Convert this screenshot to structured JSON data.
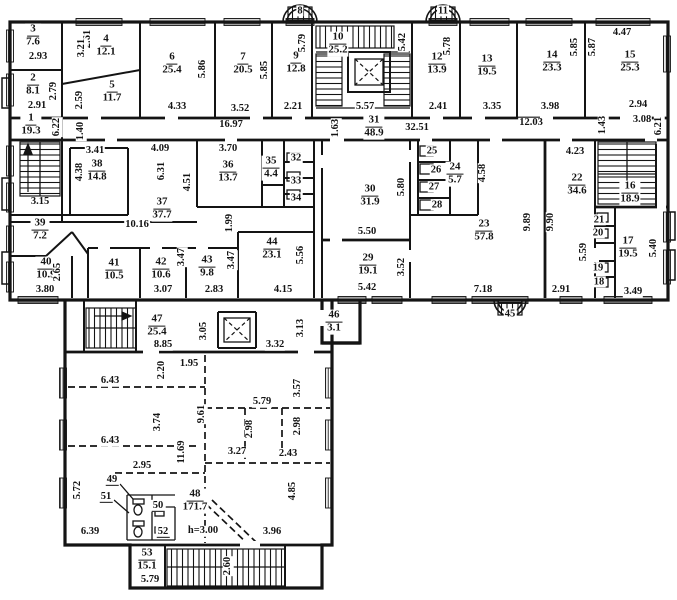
{
  "plan": {
    "type": "architectural-floor-plan",
    "colors": {
      "ink": "#141414",
      "background": "#ffffff"
    },
    "rooms": [
      {
        "num": "3",
        "area": "7.6",
        "x": 33,
        "y": 36
      },
      {
        "num": "2",
        "area": "8.1",
        "x": 33,
        "y": 85
      },
      {
        "num": "1",
        "area": "19.3",
        "x": 31,
        "y": 125
      },
      {
        "num": "4",
        "area": "12.1",
        "x": 106,
        "y": 46
      },
      {
        "num": "5",
        "area": "11.7",
        "x": 112,
        "y": 92
      },
      {
        "num": "6",
        "area": "25.4",
        "x": 172,
        "y": 64
      },
      {
        "num": "7",
        "area": "20.5",
        "x": 243,
        "y": 64
      },
      {
        "num": "9",
        "area": "12.8",
        "x": 296,
        "y": 63
      },
      {
        "num": "10",
        "area": "25.2",
        "x": 338,
        "y": 44
      },
      {
        "num": "12",
        "area": "13.9",
        "x": 437,
        "y": 64
      },
      {
        "num": "13",
        "area": "19.5",
        "x": 487,
        "y": 66
      },
      {
        "num": "14",
        "area": "23.3",
        "x": 552,
        "y": 62
      },
      {
        "num": "15",
        "area": "25.3",
        "x": 630,
        "y": 62
      },
      {
        "num": "31",
        "area": "48.9",
        "x": 374,
        "y": 127
      },
      {
        "num": "38",
        "area": "14.8",
        "x": 97,
        "y": 171
      },
      {
        "num": "37",
        "area": "37.7",
        "x": 162,
        "y": 209
      },
      {
        "num": "36",
        "area": "13.7",
        "x": 228,
        "y": 172
      },
      {
        "num": "35",
        "area": "4.4",
        "x": 271,
        "y": 168
      },
      {
        "num": "30",
        "area": "31.9",
        "x": 370,
        "y": 196
      },
      {
        "num": "24",
        "area": "5.7",
        "x": 455,
        "y": 174
      },
      {
        "num": "23",
        "area": "57.8",
        "x": 484,
        "y": 231
      },
      {
        "num": "22",
        "area": "34.6",
        "x": 577,
        "y": 185
      },
      {
        "num": "16",
        "area": "18.9",
        "x": 630,
        "y": 193
      },
      {
        "num": "17",
        "area": "19.5",
        "x": 628,
        "y": 248
      },
      {
        "num": "39",
        "area": "7.2",
        "x": 40,
        "y": 230
      },
      {
        "num": "40",
        "area": "10.9",
        "x": 46,
        "y": 269
      },
      {
        "num": "41",
        "area": "10.5",
        "x": 114,
        "y": 270
      },
      {
        "num": "42",
        "area": "10.6",
        "x": 161,
        "y": 269
      },
      {
        "num": "43",
        "area": "9.8",
        "x": 207,
        "y": 267
      },
      {
        "num": "44",
        "area": "23.1",
        "x": 272,
        "y": 249
      },
      {
        "num": "29",
        "area": "19.1",
        "x": 368,
        "y": 265
      },
      {
        "num": "46",
        "area": "3.1",
        "x": 334,
        "y": 322
      },
      {
        "num": "47",
        "area": "25.4",
        "x": 157,
        "y": 326
      },
      {
        "num": "48",
        "area": "171.7",
        "x": 195,
        "y": 501
      },
      {
        "num": "53",
        "area": "15.1",
        "x": 147,
        "y": 560
      },
      {
        "num": "8",
        "area": "",
        "x": 300,
        "y": 11,
        "plain": 1
      },
      {
        "num": "11",
        "area": "",
        "x": 443,
        "y": 11,
        "plain": 1
      },
      {
        "num": "45",
        "area": "",
        "x": 510,
        "y": 314,
        "plain": 1
      },
      {
        "num": "32",
        "area": "",
        "x": 296,
        "y": 158,
        "plain": 1
      },
      {
        "num": "33",
        "area": "",
        "x": 296,
        "y": 181,
        "plain": 1
      },
      {
        "num": "34",
        "area": "",
        "x": 296,
        "y": 198,
        "plain": 1
      },
      {
        "num": "25",
        "area": "",
        "x": 432,
        "y": 151,
        "plain": 1
      },
      {
        "num": "26",
        "area": "",
        "x": 436,
        "y": 170,
        "plain": 1
      },
      {
        "num": "27",
        "area": "",
        "x": 434,
        "y": 187,
        "plain": 1
      },
      {
        "num": "28",
        "area": "",
        "x": 437,
        "y": 205,
        "plain": 1
      },
      {
        "num": "21",
        "area": "",
        "x": 599,
        "y": 220,
        "plain": 1
      },
      {
        "num": "20",
        "area": "",
        "x": 598,
        "y": 233,
        "plain": 1
      },
      {
        "num": "19",
        "area": "",
        "x": 598,
        "y": 268,
        "plain": 1
      },
      {
        "num": "18",
        "area": "",
        "x": 599,
        "y": 282,
        "plain": 1
      },
      {
        "num": "49",
        "area": "",
        "x": 112,
        "y": 480,
        "plain": 1,
        "u": 1
      },
      {
        "num": "51",
        "area": "",
        "x": 106,
        "y": 497,
        "plain": 1,
        "u": 1
      },
      {
        "num": "50",
        "area": "",
        "x": 158,
        "y": 506,
        "plain": 1,
        "u": 1
      },
      {
        "num": "52",
        "area": "",
        "x": 163,
        "y": 532,
        "plain": 1,
        "u": 1
      }
    ],
    "dims": [
      {
        "t": "2.61",
        "x": 88,
        "y": 39,
        "r": 1
      },
      {
        "t": "3.21",
        "x": 82,
        "y": 48,
        "r": 1
      },
      {
        "t": "2.93",
        "x": 38,
        "y": 57
      },
      {
        "t": "2.79",
        "x": 54,
        "y": 91,
        "r": 1
      },
      {
        "t": "2.59",
        "x": 80,
        "y": 100,
        "r": 1
      },
      {
        "t": "2.91",
        "x": 37,
        "y": 106
      },
      {
        "t": "6.22",
        "x": 57,
        "y": 127,
        "r": 1
      },
      {
        "t": "1.40",
        "x": 81,
        "y": 131,
        "r": 1
      },
      {
        "t": "5.86",
        "x": 203,
        "y": 69,
        "r": 1
      },
      {
        "t": "4.33",
        "x": 177,
        "y": 107
      },
      {
        "t": "5.85",
        "x": 265,
        "y": 70,
        "r": 1
      },
      {
        "t": "3.52",
        "x": 240,
        "y": 109
      },
      {
        "t": "5.79",
        "x": 303,
        "y": 43,
        "r": 1
      },
      {
        "t": "2.21",
        "x": 293,
        "y": 107
      },
      {
        "t": "16.97",
        "x": 231,
        "y": 125
      },
      {
        "t": "5.42",
        "x": 403,
        "y": 42,
        "r": 1
      },
      {
        "t": "5.57",
        "x": 365,
        "y": 107
      },
      {
        "t": "1.63",
        "x": 336,
        "y": 128,
        "r": 1
      },
      {
        "t": "32.51",
        "x": 417,
        "y": 128
      },
      {
        "t": "5.78",
        "x": 448,
        "y": 46,
        "r": 1
      },
      {
        "t": "2.41",
        "x": 438,
        "y": 107
      },
      {
        "t": "5.85",
        "x": 575,
        "y": 47,
        "r": 1
      },
      {
        "t": "3.35",
        "x": 492,
        "y": 107
      },
      {
        "t": "3.98",
        "x": 550,
        "y": 107
      },
      {
        "t": "5.87",
        "x": 593,
        "y": 47,
        "r": 1
      },
      {
        "t": "4.47",
        "x": 622,
        "y": 33
      },
      {
        "t": "2.94",
        "x": 638,
        "y": 105
      },
      {
        "t": "3.08",
        "x": 642,
        "y": 120
      },
      {
        "t": "6.21",
        "x": 659,
        "y": 126,
        "r": 1
      },
      {
        "t": "1.43",
        "x": 603,
        "y": 125,
        "r": 1
      },
      {
        "t": "12.03",
        "x": 531,
        "y": 123
      },
      {
        "t": "3.41",
        "x": 95,
        "y": 151
      },
      {
        "t": "4.38",
        "x": 80,
        "y": 172,
        "r": 1
      },
      {
        "t": "4.09",
        "x": 160,
        "y": 149
      },
      {
        "t": "6.31",
        "x": 162,
        "y": 171,
        "r": 1
      },
      {
        "t": "4.51",
        "x": 188,
        "y": 182,
        "r": 1
      },
      {
        "t": "3.70",
        "x": 228,
        "y": 149
      },
      {
        "t": "3.15",
        "x": 40,
        "y": 202
      },
      {
        "t": "10.16",
        "x": 137,
        "y": 225
      },
      {
        "t": "1.99",
        "x": 230,
        "y": 223,
        "r": 1
      },
      {
        "t": "5.80",
        "x": 402,
        "y": 187,
        "r": 1
      },
      {
        "t": "5.50",
        "x": 367,
        "y": 232
      },
      {
        "t": "4.58",
        "x": 483,
        "y": 173,
        "r": 1
      },
      {
        "t": "4.23",
        "x": 575,
        "y": 152
      },
      {
        "t": "9.89",
        "x": 528,
        "y": 222,
        "r": 1
      },
      {
        "t": "9.90",
        "x": 551,
        "y": 222,
        "r": 1
      },
      {
        "t": "5.59",
        "x": 584,
        "y": 252,
        "r": 1
      },
      {
        "t": "5.40",
        "x": 654,
        "y": 248,
        "r": 1
      },
      {
        "t": "3.49",
        "x": 633,
        "y": 292
      },
      {
        "t": "2.91",
        "x": 561,
        "y": 290
      },
      {
        "t": "7.18",
        "x": 483,
        "y": 290
      },
      {
        "t": "2.65",
        "x": 58,
        "y": 272,
        "r": 1
      },
      {
        "t": "3.80",
        "x": 45,
        "y": 290
      },
      {
        "t": "3.07",
        "x": 163,
        "y": 290
      },
      {
        "t": "3.47",
        "x": 182,
        "y": 257,
        "r": 1
      },
      {
        "t": "3.47",
        "x": 232,
        "y": 260,
        "r": 1
      },
      {
        "t": "2.83",
        "x": 214,
        "y": 290
      },
      {
        "t": "5.56",
        "x": 301,
        "y": 255,
        "r": 1
      },
      {
        "t": "4.15",
        "x": 283,
        "y": 290
      },
      {
        "t": "3.52",
        "x": 402,
        "y": 267,
        "r": 1
      },
      {
        "t": "5.42",
        "x": 367,
        "y": 288
      },
      {
        "t": "3.13",
        "x": 301,
        "y": 328,
        "r": 1
      },
      {
        "t": "3.32",
        "x": 275,
        "y": 345
      },
      {
        "t": "8.85",
        "x": 163,
        "y": 345
      },
      {
        "t": "3.05",
        "x": 204,
        "y": 331,
        "r": 1
      },
      {
        "t": "1.95",
        "x": 189,
        "y": 364
      },
      {
        "t": "2.20",
        "x": 162,
        "y": 370,
        "r": 1
      },
      {
        "t": "6.43",
        "x": 110,
        "y": 381
      },
      {
        "t": "3.74",
        "x": 158,
        "y": 422,
        "r": 1
      },
      {
        "t": "6.43",
        "x": 110,
        "y": 441
      },
      {
        "t": "9.61",
        "x": 202,
        "y": 414,
        "r": 1
      },
      {
        "t": "11.69",
        "x": 182,
        "y": 452,
        "r": 1
      },
      {
        "t": "5.79",
        "x": 262,
        "y": 402
      },
      {
        "t": "2.98",
        "x": 250,
        "y": 429,
        "r": 1
      },
      {
        "t": "2.98",
        "x": 298,
        "y": 426,
        "r": 1
      },
      {
        "t": "3.57",
        "x": 298,
        "y": 388,
        "r": 1
      },
      {
        "t": "3.27",
        "x": 237,
        "y": 452
      },
      {
        "t": "2.43",
        "x": 288,
        "y": 454
      },
      {
        "t": "2.95",
        "x": 142,
        "y": 466
      },
      {
        "t": "5.72",
        "x": 78,
        "y": 490,
        "r": 1
      },
      {
        "t": "6.39",
        "x": 90,
        "y": 532
      },
      {
        "t": "h=3.00",
        "x": 203,
        "y": 531
      },
      {
        "t": "3.96",
        "x": 272,
        "y": 532
      },
      {
        "t": "4.85",
        "x": 293,
        "y": 491,
        "r": 1
      },
      {
        "t": "2.60",
        "x": 228,
        "y": 566,
        "r": 1
      },
      {
        "t": "5.79",
        "x": 150,
        "y": 580
      }
    ]
  }
}
